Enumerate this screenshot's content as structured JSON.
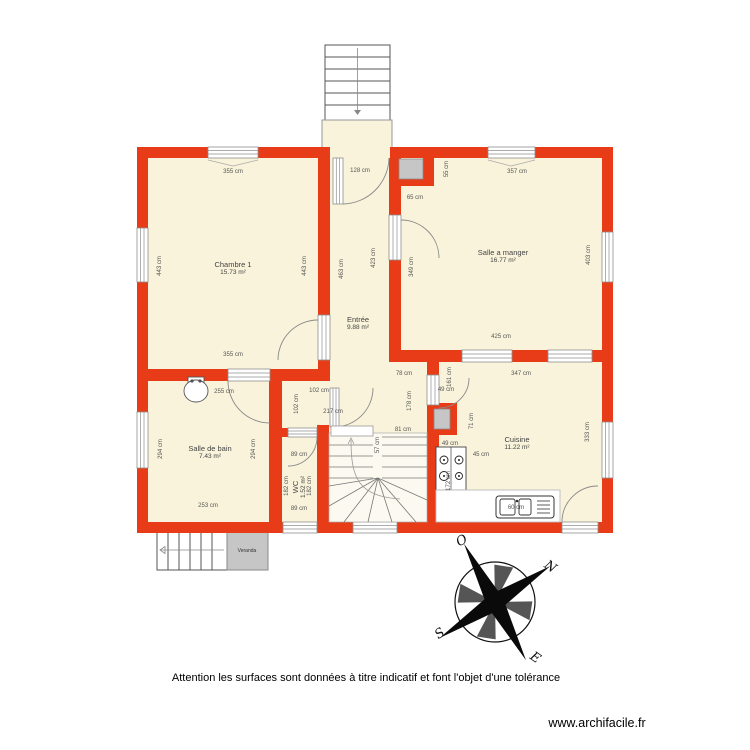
{
  "footer": {
    "disclaimer": "Attention les surfaces sont données à titre indicatif et font l'objet d'une tolérance",
    "website": "www.archifacile.fr"
  },
  "colors": {
    "wall_red": "#e73c17",
    "floor_cream": "#f8f3da",
    "fixture_gray": "#c6c6c6",
    "line_gray": "#8f8f8f"
  },
  "rooms": [
    {
      "name": "Chambre 1",
      "area": "15.73 m²",
      "x": 233,
      "y": 268,
      "rot": 0
    },
    {
      "name": "Entrée",
      "area": "9.88 m²",
      "x": 358,
      "y": 323,
      "rot": 0
    },
    {
      "name": "Salle a manger",
      "area": "16.77 m²",
      "x": 503,
      "y": 256,
      "rot": 0
    },
    {
      "name": "Salle de bain",
      "area": "7.43 m²",
      "x": 210,
      "y": 452,
      "rot": 0
    },
    {
      "name": "Cuisine",
      "area": "11.22 m²",
      "x": 517,
      "y": 443,
      "rot": 0
    },
    {
      "name": "WC",
      "area": "1.52 m²",
      "x": 299,
      "y": 487,
      "rot": -90
    }
  ],
  "annex_labels": [
    {
      "text": "Veranda",
      "x": 247,
      "y": 551
    }
  ],
  "dim_labels": [
    {
      "text": "355 cm",
      "x": 233,
      "y": 172,
      "rot": 0
    },
    {
      "text": "128 cm",
      "x": 360,
      "y": 171,
      "rot": 0
    },
    {
      "text": "55 cm",
      "x": 447,
      "y": 169,
      "rot": -90
    },
    {
      "text": "357 cm",
      "x": 517,
      "y": 172,
      "rot": 0
    },
    {
      "text": "65 cm",
      "x": 415,
      "y": 198,
      "rot": 0
    },
    {
      "text": "443 cm",
      "x": 160,
      "y": 266,
      "rot": -90
    },
    {
      "text": "443 cm",
      "x": 305,
      "y": 266,
      "rot": -90
    },
    {
      "text": "463 cm",
      "x": 342,
      "y": 269,
      "rot": -90
    },
    {
      "text": "423 cm",
      "x": 374,
      "y": 258,
      "rot": -90
    },
    {
      "text": "349 cm",
      "x": 412,
      "y": 267,
      "rot": -90
    },
    {
      "text": "403 cm",
      "x": 589,
      "y": 255,
      "rot": -90
    },
    {
      "text": "355 cm",
      "x": 233,
      "y": 355,
      "rot": 0
    },
    {
      "text": "425 cm",
      "x": 501,
      "y": 337,
      "rot": 0
    },
    {
      "text": "78 cm",
      "x": 404,
      "y": 374,
      "rot": 0
    },
    {
      "text": "347 cm",
      "x": 521,
      "y": 374,
      "rot": 0
    },
    {
      "text": "102 cm",
      "x": 319,
      "y": 391,
      "rot": 0
    },
    {
      "text": "102 cm",
      "x": 297,
      "y": 404,
      "rot": -90
    },
    {
      "text": "217 cm",
      "x": 333,
      "y": 412,
      "rot": 0
    },
    {
      "text": "161 cm",
      "x": 450,
      "y": 377,
      "rot": -90
    },
    {
      "text": "49 cm",
      "x": 446,
      "y": 390,
      "rot": 0
    },
    {
      "text": "178 cm",
      "x": 410,
      "y": 401,
      "rot": -90
    },
    {
      "text": "71 cm",
      "x": 472,
      "y": 421,
      "rot": -90
    },
    {
      "text": "333 cm",
      "x": 588,
      "y": 432,
      "rot": -90
    },
    {
      "text": "255 cm",
      "x": 224,
      "y": 392,
      "rot": 0
    },
    {
      "text": "294 cm",
      "x": 161,
      "y": 449,
      "rot": -90
    },
    {
      "text": "294 cm",
      "x": 254,
      "y": 449,
      "rot": -90
    },
    {
      "text": "253 cm",
      "x": 208,
      "y": 506,
      "rot": 0
    },
    {
      "text": "89 cm",
      "x": 299,
      "y": 455,
      "rot": 0
    },
    {
      "text": "89 cm",
      "x": 299,
      "y": 509,
      "rot": 0
    },
    {
      "text": "182 cm",
      "x": 287,
      "y": 486,
      "rot": -90
    },
    {
      "text": "182 cm",
      "x": 310,
      "y": 486,
      "rot": -90
    },
    {
      "text": "81 cm",
      "x": 403,
      "y": 430,
      "rot": 0
    },
    {
      "text": "57 cm",
      "x": 378,
      "y": 445,
      "rot": -90
    },
    {
      "text": "49 cm",
      "x": 450,
      "y": 444,
      "rot": 0
    },
    {
      "text": "45 cm",
      "x": 481,
      "y": 455,
      "rot": 0
    },
    {
      "text": "172 cm",
      "x": 449,
      "y": 481,
      "rot": -90
    },
    {
      "text": "60 cm",
      "x": 516,
      "y": 508,
      "rot": 0
    }
  ],
  "compass": {
    "letters": [
      {
        "text": "O",
        "x": 462,
        "y": 541,
        "rot": -30
      },
      {
        "text": "N",
        "x": 550,
        "y": 567,
        "rot": 35
      },
      {
        "text": "S",
        "x": 440,
        "y": 634,
        "rot": -35
      },
      {
        "text": "E",
        "x": 535,
        "y": 658,
        "rot": 35
      }
    ]
  }
}
